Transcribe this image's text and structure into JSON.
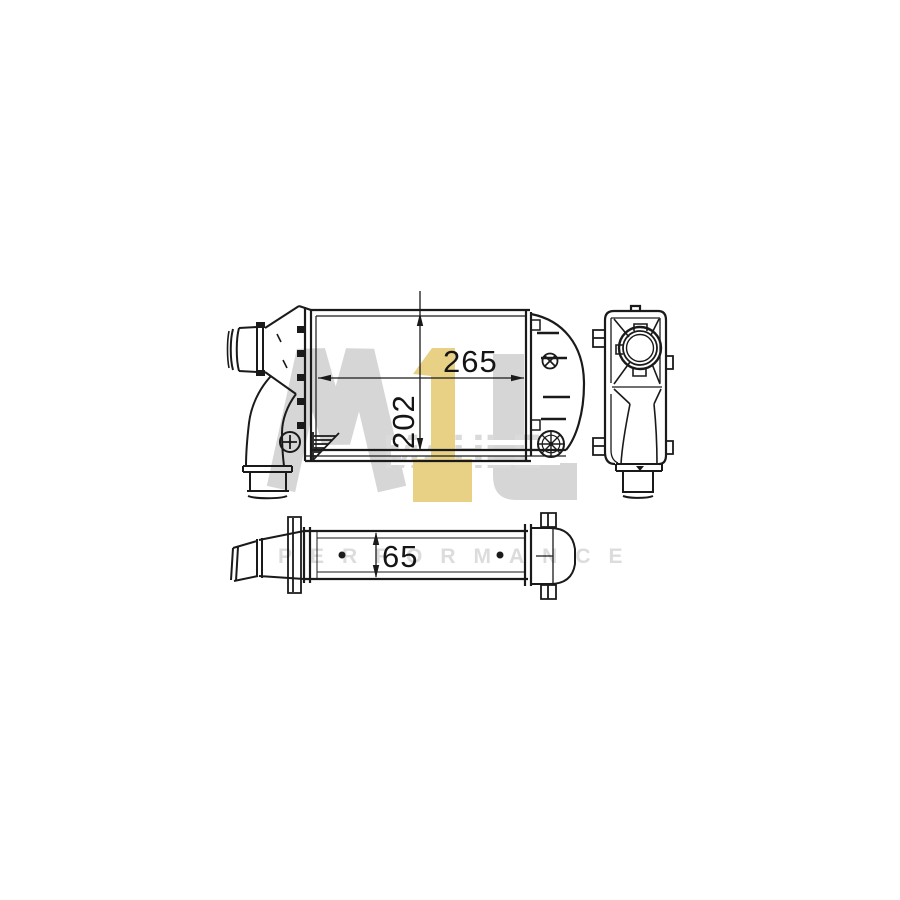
{
  "page": {
    "background": "#ffffff"
  },
  "drawing": {
    "subject": "intercooler-three-view-technical-drawing",
    "line_color": "#1a1a1a",
    "dimensions": {
      "width": "265",
      "height": "202",
      "depth": "65"
    }
  },
  "watermark": {
    "logo_text": "M1L",
    "overlay_text": "MAHLE",
    "subtitle": "PERFORMANCE",
    "gray": "#d6d6d6",
    "overlay_gray": "#dadada",
    "subtitle_gray": "#dcdcdc",
    "gold": "#e8d185"
  }
}
